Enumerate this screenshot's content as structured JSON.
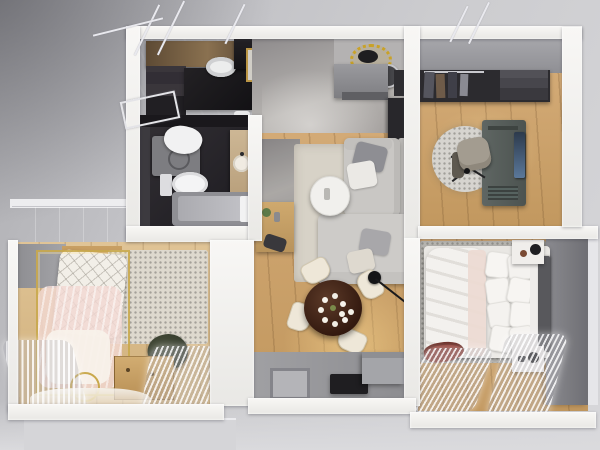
{
  "scene": {
    "kind": "3D apartment floor plan render",
    "view": "top-down bird's-eye",
    "canvas": {
      "width": 600,
      "height": 450
    }
  },
  "palette": {
    "backdrop": "#c6c6ca",
    "wall_white": "#f3f2f0",
    "concrete_gray": "#9a9a9f",
    "marble_dark": "#2c2a2e",
    "marble_light": "#a8a5a2",
    "wood_warm": "#cfa56b",
    "wood_light": "#dcc094",
    "rug_beige": "#d7d2c7",
    "rug_gray": "#b7b5b0",
    "sofa_gray": "#c9c7c4",
    "table_walnut": "#3d241a",
    "chair_cream": "#eee7d8",
    "bed_white": "#f3f1ee",
    "headboard_gray": "#58585c",
    "accent_wall": "#7c7c81",
    "gold": "#c9a84c",
    "canopy_pink": "#f0d8d2",
    "chair_green": "#3e4534",
    "throw_red": "#8e3c33"
  },
  "rooms": [
    {
      "name": "Kitchen",
      "furniture": [
        "upper cabinets",
        "open shelving",
        "black island counter",
        "round vessel sink",
        "gold wall frame",
        "bar glasses",
        "rolled towels"
      ]
    },
    {
      "name": "Bathroom",
      "furniture": [
        "washing machine",
        "laundry pile",
        "toilet",
        "wood vanity with round sink",
        "bathtub",
        "towel"
      ]
    },
    {
      "name": "Living & Dining Room",
      "furniture": [
        "gold sunburst clock",
        "round wall mirror",
        "media cabinet",
        "gray sideboard",
        "L-shaped gray sofa",
        "throw pillows",
        "round white coffee table",
        "wood console",
        "black stool",
        "round walnut dining table",
        "white flower centerpiece",
        "cream dining chairs",
        "black arc floor lamp"
      ]
    },
    {
      "name": "Entrance Hall",
      "furniture": [
        "doormat",
        "black shoe bench",
        "gray console cabinet"
      ]
    },
    {
      "name": "Home Office",
      "furniture": [
        "open wardrobe with clothes",
        "shelf unit",
        "round shaggy rug",
        "desk",
        "monitor",
        "office chair"
      ]
    },
    {
      "name": "Master Bedroom",
      "furniture": [
        "double bed",
        "white duvet",
        "pillows",
        "bolster",
        "dark headboard",
        "white nightstands",
        "black table lamps",
        "red throw",
        "gray rug",
        "dark accent wall",
        "sheer curtains"
      ]
    },
    {
      "name": "Nursery",
      "furniture": [
        "gray wardrobe",
        "gold canopy crib",
        "quilted blanket",
        "pink sheer canopy",
        "area rug",
        "dark green armchair",
        "wood dresser",
        "gold floor ring",
        "sheer curtains"
      ]
    }
  ],
  "counts": {
    "rooms": 7,
    "dining_chairs": 4,
    "bed_pillows": 8
  }
}
